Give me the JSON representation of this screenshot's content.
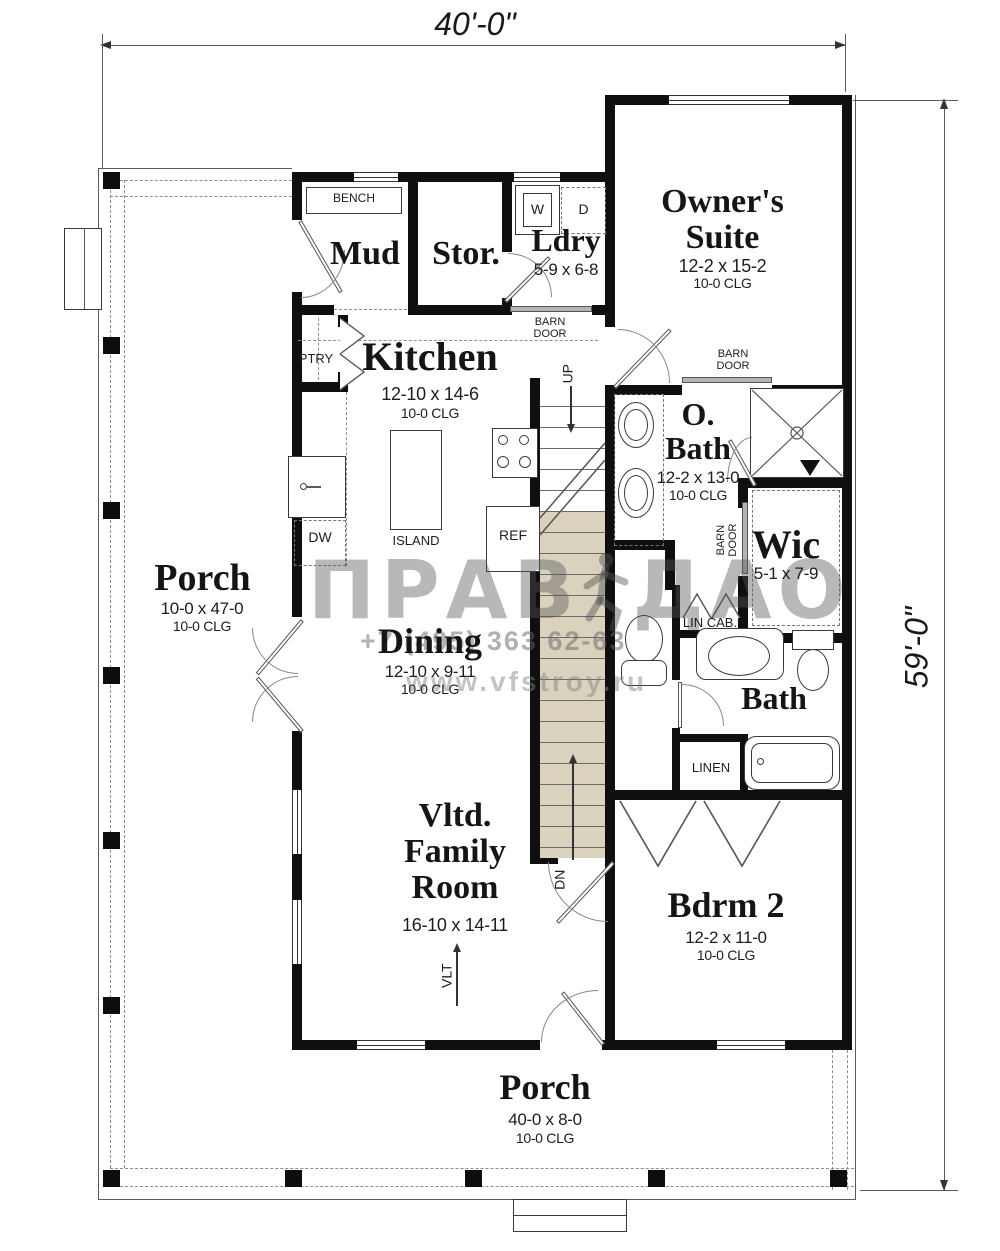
{
  "dimensions": {
    "width": "40'-0\"",
    "height": "59'-0\""
  },
  "rooms": {
    "owners": {
      "line1": "Owner's",
      "line2": "Suite",
      "size": "12-2 x 15-2",
      "clg": "10-0 CLG"
    },
    "mud": {
      "name": "Mud"
    },
    "stor": {
      "name": "Stor."
    },
    "ldry": {
      "name": "Ldry",
      "size": "5-9 x 6-8"
    },
    "kitchen": {
      "name": "Kitchen",
      "size": "12-10 x 14-6",
      "clg": "10-0 CLG"
    },
    "obath": {
      "line1": "O.",
      "line2": "Bath",
      "size": "12-2 x 13-0",
      "clg": "10-0 CLG"
    },
    "wic": {
      "name": "Wic",
      "size": "5-1 x 7-9"
    },
    "porch_left": {
      "name": "Porch",
      "size": "10-0 x 47-0",
      "clg": "10-0 CLG"
    },
    "dining": {
      "name": "Dining",
      "size": "12-10 x 9-11",
      "clg": "10-0 CLG"
    },
    "bath": {
      "name": "Bath"
    },
    "family": {
      "line1": "Vltd.",
      "line2": "Family",
      "line3": "Room",
      "size": "16-10 x 14-11"
    },
    "bdrm2": {
      "name": "Bdrm 2",
      "size": "12-2 x 11-0",
      "clg": "10-0 CLG"
    },
    "porch_bottom": {
      "name": "Porch",
      "size": "40-0 x 8-0",
      "clg": "10-0 CLG"
    }
  },
  "labels": {
    "bench": "BENCH",
    "washer": "W",
    "dryer": "D",
    "barn": "BARN",
    "door": "DOOR",
    "ptry": "PTRY",
    "dw": "DW",
    "island": "ISLAND",
    "ref": "REF",
    "up": "UP",
    "dn": "DN",
    "lin_cab": "LIN CAB.",
    "linen": "LINEN",
    "vlt": "VLT"
  },
  "watermark": {
    "brand1": "ПРАВ",
    "brand2": "ДАО",
    "phone": "+7 (495) 363 62-63",
    "site": "www.vfstroy.ru"
  },
  "colors": {
    "wall": "#0f0f0f",
    "stair_fill": "#dbd2bd",
    "watermark_gray": "#8a8a8a"
  }
}
